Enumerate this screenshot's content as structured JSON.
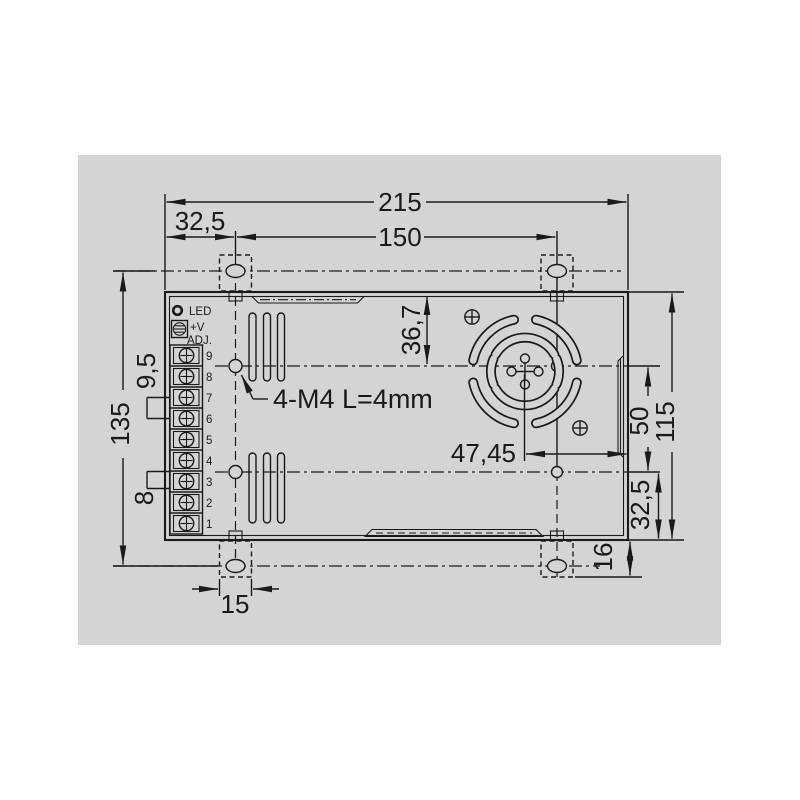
{
  "drawing": {
    "type": "mechanical-dimension-drawing",
    "unit": "mm",
    "dims": {
      "overall_width": "215",
      "hole_offset_left": "32,5",
      "hole_spacing_x": "150",
      "mounting_span": "135",
      "terminal_pitch": "9,5",
      "terminal_width": "8",
      "bracket_width": "15",
      "fan_center_from_top": "36,7",
      "fan_center_to_right": "47,45",
      "hole_spacing_y": "50",
      "case_depth": "115",
      "hole_offset_bottom": "32,5",
      "bracket_height": "16"
    },
    "notes": {
      "mounting_holes": "4-M4 L=4mm"
    },
    "front_panel": {
      "led_label": "LED",
      "pot_label_line1": "+V",
      "pot_label_line2": "ADJ."
    },
    "terminals": {
      "labels": [
        "9",
        "8",
        "7",
        "6",
        "5",
        "4",
        "3",
        "2",
        "1"
      ]
    },
    "colors": {
      "panel_background": "#d4d4d4",
      "line": "#1a1a1a",
      "page_background": "#ffffff"
    }
  }
}
